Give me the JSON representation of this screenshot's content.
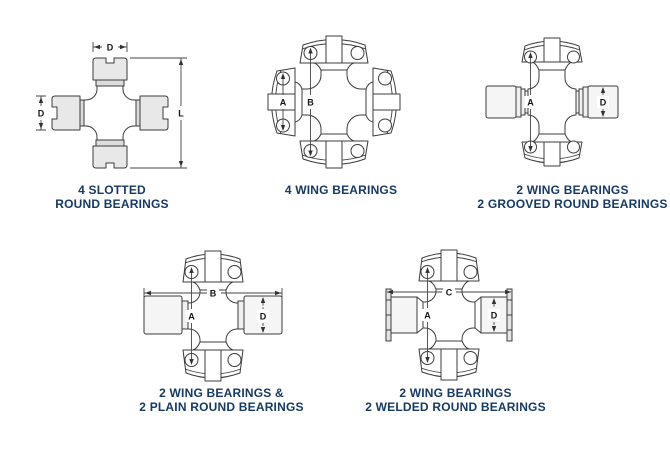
{
  "page": {
    "background": "#ffffff",
    "caption_color": "#173a64",
    "line_color": "#3c3c3c"
  },
  "figures": [
    {
      "caption": [
        "4 SLOTTED",
        "ROUND BEARINGS"
      ],
      "labels": {
        "diameter_top": "D",
        "diameter_left": "D",
        "length": "L"
      }
    },
    {
      "caption": [
        "4 WING BEARINGS"
      ],
      "labels": {
        "a": "A",
        "b": "B"
      }
    },
    {
      "caption": [
        "2 WING BEARINGS",
        "2 GROOVED ROUND BEARINGS"
      ],
      "labels": {
        "a": "A",
        "d": "D"
      }
    },
    {
      "caption": [
        "2 WING BEARINGS &",
        "2 PLAIN ROUND BEARINGS"
      ],
      "labels": {
        "a": "A",
        "b": "B",
        "d": "D"
      }
    },
    {
      "caption": [
        "2 WING BEARINGS",
        "2 WELDED ROUND BEARINGS"
      ],
      "labels": {
        "a": "A",
        "c": "C",
        "d": "D"
      }
    }
  ]
}
